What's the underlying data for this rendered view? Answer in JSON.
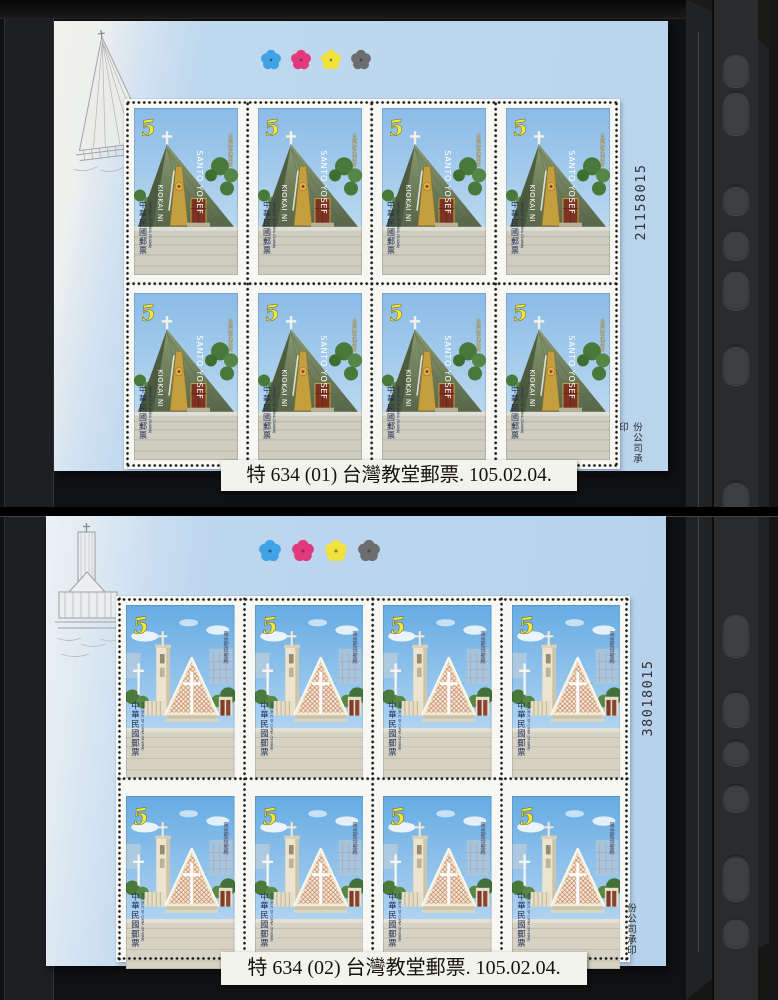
{
  "scene": {
    "description": "Two mint plate blocks of Taiwan church stamps mounted on black stockbook pages",
    "background_color": "#101113",
    "selvage_color": "#bcd6ed"
  },
  "sheets": [
    {
      "caption": "特 634 (01) 台灣教堂郵票. 105.02.04.",
      "serial_number": "21158015",
      "printer_imprint": "份公司承印",
      "grid": {
        "rows": 2,
        "cols": 4
      },
      "color_check_colors": [
        "#3fa3e6",
        "#e2397e",
        "#efe33c",
        "#6d6d6f"
      ],
      "stamp": {
        "design": "pyramid-church",
        "denomination": "5",
        "denomination_color": "#f3e83a",
        "country_cjk": "中華民國郵票",
        "country_latin": "REPUBLIC OF CHINA (TAIWAN)",
        "inscription_1": "SANTO YOSEF",
        "inscription_2": "KIOKAI NI",
        "church_name_cjk": "金崙聖若瑟堂"
      }
    },
    {
      "caption": "特 634 (02) 台灣教堂郵票. 105.02.04.",
      "serial_number": "38018015",
      "printer_imprint": "份公司承印",
      "grid": {
        "rows": 2,
        "cols": 4
      },
      "color_check_colors": [
        "#3fa3e6",
        "#e2397e",
        "#efe33c",
        "#6d6d6f"
      ],
      "stamp": {
        "design": "tower-church",
        "denomination": "5",
        "denomination_color": "#f3e83a",
        "country_cjk": "中華民國郵票",
        "country_latin": "REPUBLIC OF CHINA (TAIWAN)",
        "church_name_cjk": "萬金聖母聖殿"
      }
    }
  ]
}
